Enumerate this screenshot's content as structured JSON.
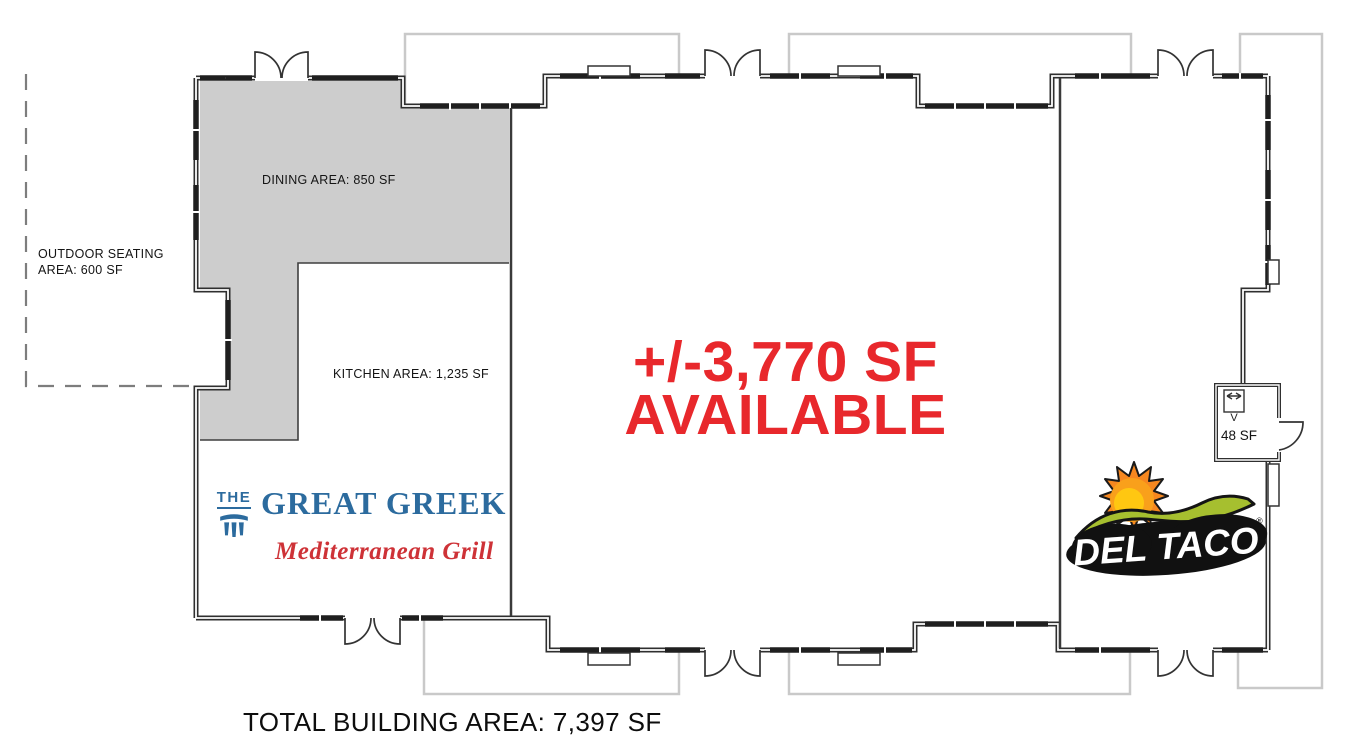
{
  "labels": {
    "outdoor_line1": "OUTDOOR SEATING",
    "outdoor_line2": "AREA: 600 SF",
    "dining": "DINING AREA: 850 SF",
    "kitchen": "KITCHEN AREA: 1,235 SF",
    "available_line1": "+/-3,770 SF",
    "available_line2": "AVAILABLE",
    "room_area": "48 SF",
    "room_marker": "V",
    "total": "TOTAL BUILDING AREA: 7,397 SF"
  },
  "tenants": {
    "great_greek": {
      "prefix": "THE",
      "name": "GREAT GREEK",
      "tagline": "Mediterranean Grill"
    },
    "del_taco": {
      "name": "DEL TACO",
      "registered": "®"
    }
  },
  "colors": {
    "available_red": "#e8282c",
    "great_greek_blue": "#2c6b9e",
    "great_greek_red": "#ce3237",
    "del_taco_green": "#a6bf2f",
    "del_taco_orange": "#f6871f",
    "del_taco_yellow": "#ffc711",
    "dining_fill": "#cdcdcd",
    "wall": "#2f2f2f",
    "canopy_outline": "#c9c9c9"
  }
}
